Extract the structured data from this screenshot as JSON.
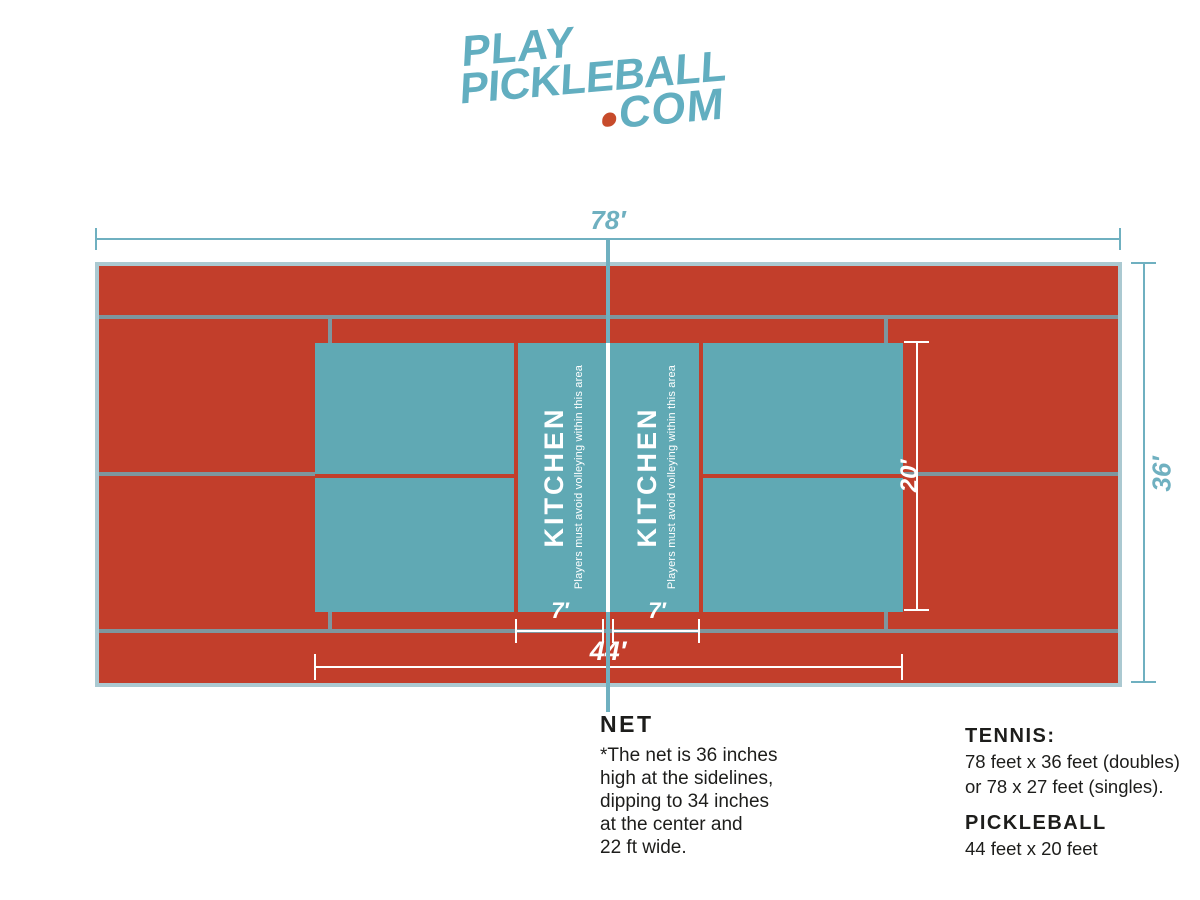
{
  "logo": {
    "word1": "PLAY",
    "word2": "PICKLEBALL",
    "word3": "COM"
  },
  "dims": {
    "tennis_length": "78′",
    "tennis_width": "36′",
    "pickleball_length": "44′",
    "pickleball_width": "20′",
    "kitchen_left": "7′",
    "kitchen_right": "7′"
  },
  "kitchen": {
    "title": "KITCHEN",
    "subtitle": "Players must avoid volleying within this area"
  },
  "net_note": {
    "title": "NET",
    "body": "*The net is 36 inches\nhigh at the sidelines,\ndipping to 34 inches\nat the center and\n22 ft wide."
  },
  "legend": {
    "tennis_title": "TENNIS:",
    "tennis_line1": "78 feet x 36 feet (doubles)",
    "tennis_line2": "or 78 x 27 feet (singles).",
    "pickleball_title": "PICKLEBALL",
    "pickleball_line": "44 feet x 20 feet"
  },
  "colors": {
    "red": "#c23e2b",
    "court_teal": "#60a9b4",
    "line_gray": "#7e969e",
    "court_border": "#abc9d1",
    "dim_teal": "#6fb0c0",
    "logo_teal": "#62aec0",
    "dot_red": "#c74b2b",
    "ink": "#1d1d1b"
  }
}
